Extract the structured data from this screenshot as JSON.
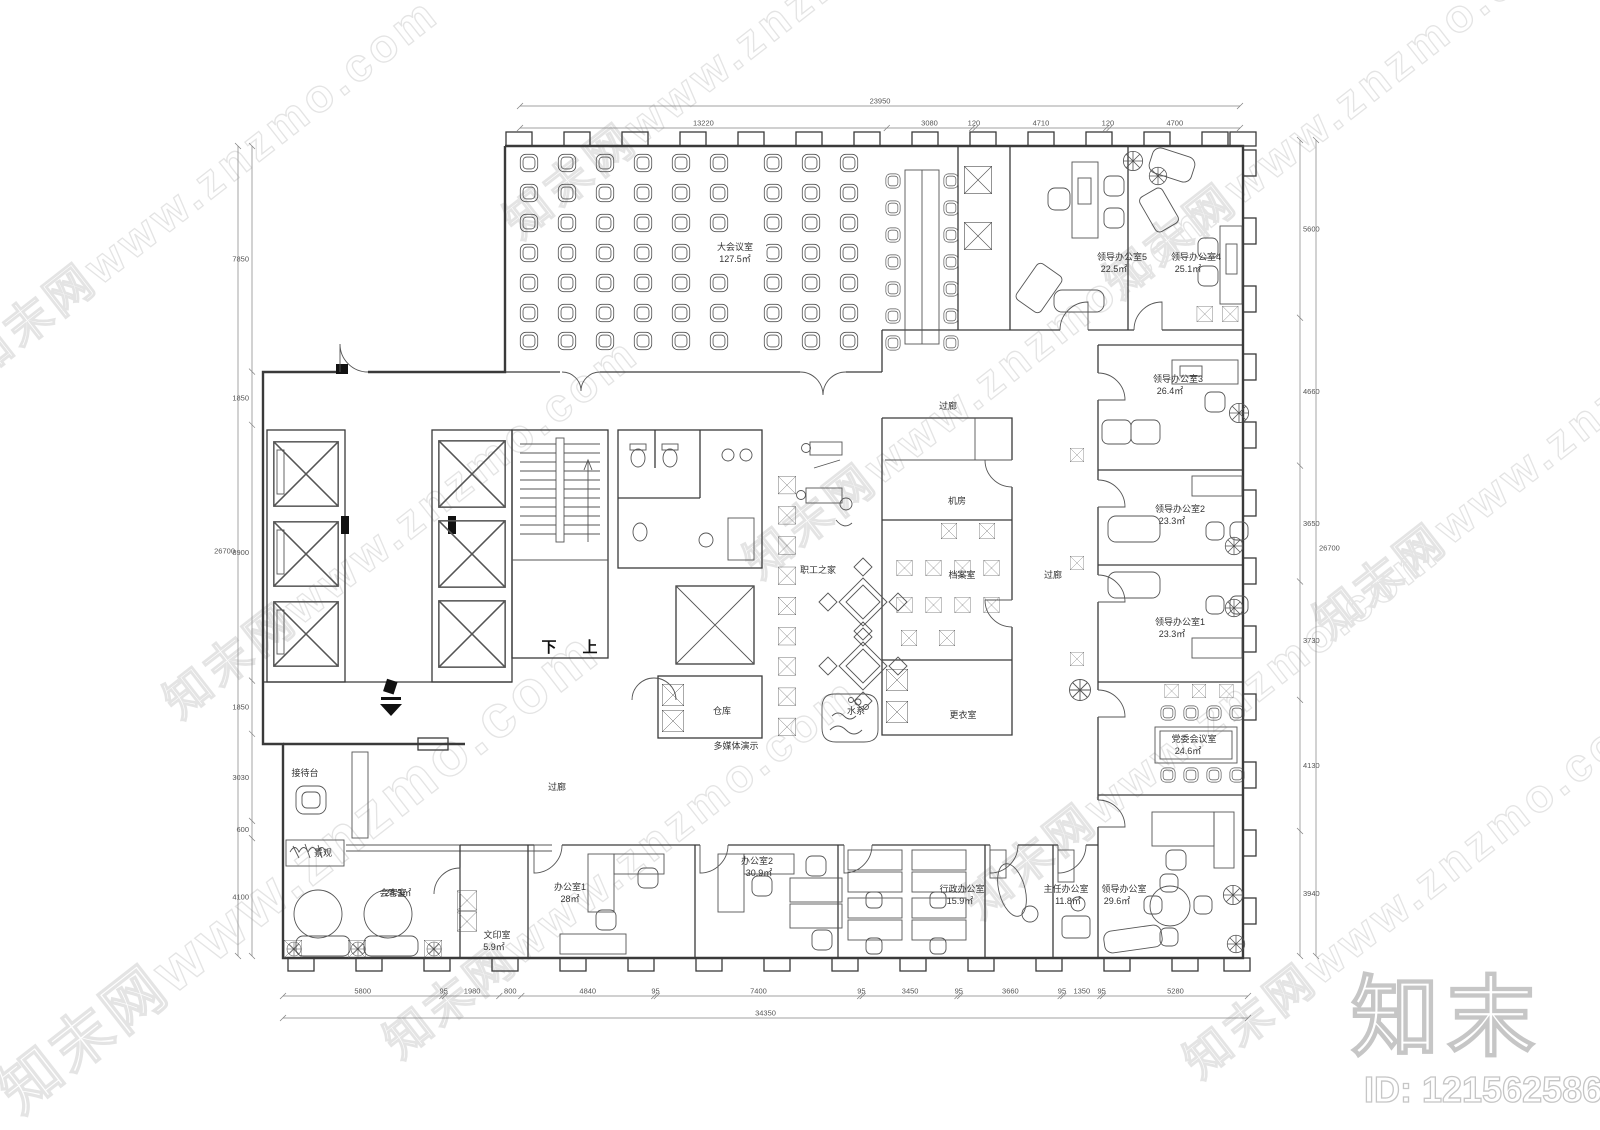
{
  "watermark": {
    "text": "知末网www.znzmo.com"
  },
  "logo": {
    "brand": "知末",
    "id_label": "ID: 1215625865"
  },
  "corridor_label": "过廊",
  "stairs": {
    "down": "下",
    "up": "上"
  },
  "rooms": {
    "conference": {
      "name": "大会议室",
      "area": "127.5㎡"
    },
    "office5": {
      "name": "领导办公室5",
      "area": "22.5㎡"
    },
    "office4": {
      "name": "领导办公室4",
      "area": "25.1㎡"
    },
    "office3": {
      "name": "领导办公室3",
      "area": "26.4㎡"
    },
    "office2": {
      "name": "领导办公室2",
      "area": "23.3㎡"
    },
    "office1": {
      "name": "领导办公室1",
      "area": "23.3㎡"
    },
    "party_meeting": {
      "name": "党委会议室",
      "area": "24.6㎡"
    },
    "leader_office": {
      "name": "领导办公室",
      "area": "29.6㎡"
    },
    "machine_room": {
      "name": "机房"
    },
    "archive": {
      "name": "档案室"
    },
    "changing": {
      "name": "更衣室"
    },
    "staff_home": {
      "name": "职工之家"
    },
    "water": {
      "name": "水系"
    },
    "storage": {
      "name": "仓库"
    },
    "multimedia": {
      "name": "多媒体演示"
    },
    "reception": {
      "name": "接待台"
    },
    "landscape": {
      "name": "景观"
    },
    "guest": {
      "name": "会客室",
      "area": "24.3㎡"
    },
    "print": {
      "name": "文印室",
      "area": "5.9㎡"
    },
    "officeA": {
      "name": "办公室1",
      "area": "28㎡"
    },
    "officeB": {
      "name": "办公室2",
      "area": "30.9㎡"
    },
    "admin": {
      "name": "行政办公室",
      "area": "15.9㎡"
    },
    "director": {
      "name": "主任办公室",
      "area": "11.8㎡"
    }
  },
  "dimensions": {
    "top_total": "23950",
    "top_segments": [
      "13220",
      "3080",
      "120",
      "4710",
      "120",
      "4700"
    ],
    "bottom_segments": [
      "5800",
      "95",
      "1980",
      "800",
      "4840",
      "95",
      "7400",
      "95",
      "3450",
      "95",
      "3660",
      "95",
      "1350",
      "95",
      "5280"
    ],
    "bottom_total": "34350",
    "left_segments": [
      "7850",
      "1850",
      "8900",
      "1850",
      "3030",
      "600",
      "4100"
    ],
    "left_total": "26700",
    "right_segments": [
      "5600",
      "4660",
      "3650",
      "3730",
      "4130",
      "3940"
    ],
    "right_total": "26700"
  }
}
